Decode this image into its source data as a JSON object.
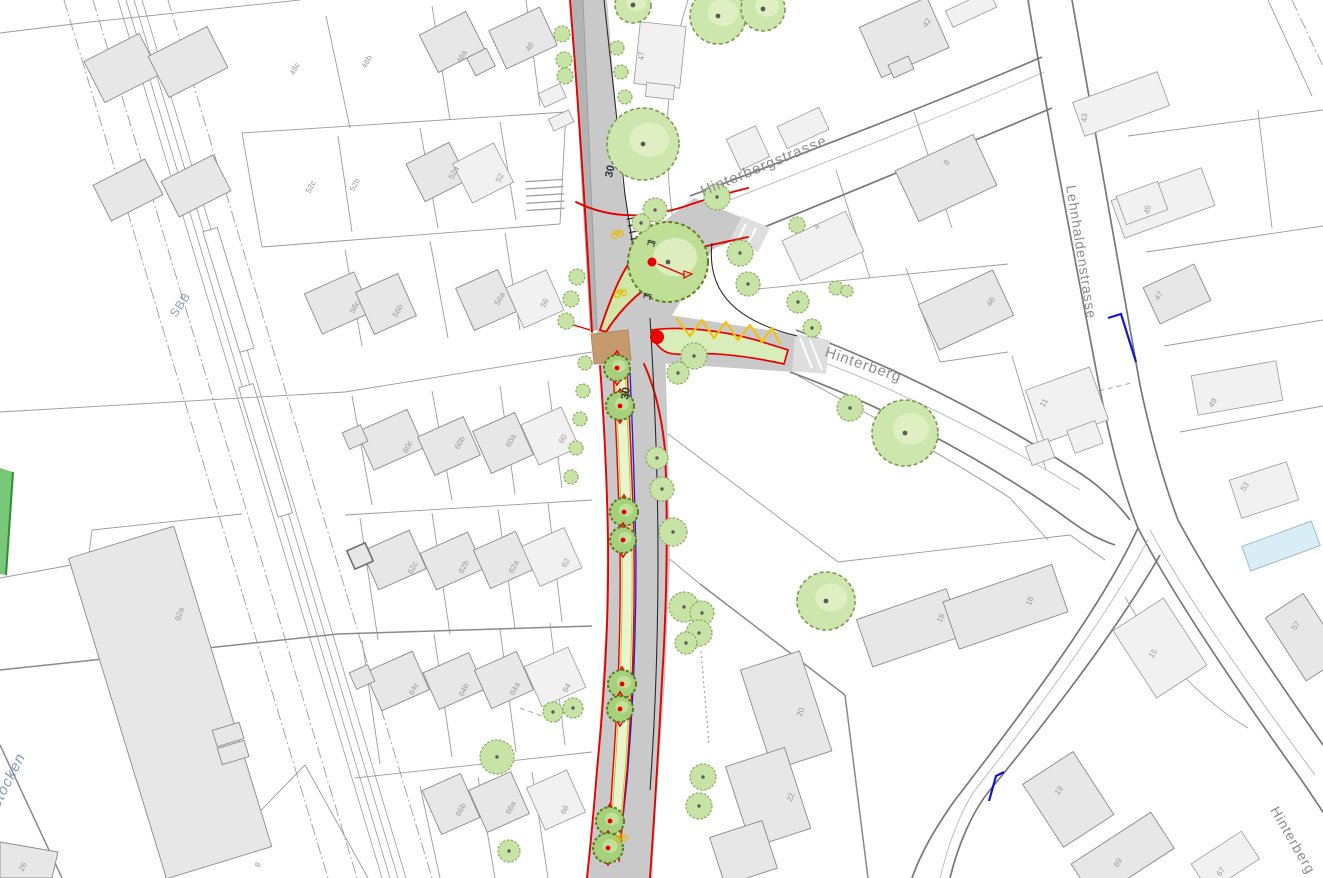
{
  "colors": {
    "parcel_line": "#9c9c9c",
    "road_border": "#787878",
    "building_fill": "#e7e7e7",
    "building_stroke": "#8a8a8a",
    "project_red": "#e60000",
    "road_gray": "#c9c9c9",
    "sidewalk_gray": "#b3b3b3",
    "median_green": "#e9f3ce",
    "tree_fill": "#cde6ad",
    "tree_outline": "#7c9a4e",
    "median_tree_fill": "#a6d07c",
    "median_tree_outline": "#5f7a1b",
    "accent_yellow": "#f2c200",
    "marking_blue": "#1414d2",
    "crossing_brown": "#c49a6e",
    "water_blue": "#d9edf6",
    "grass_green": "#79c879",
    "building_label_gray": "#9a9a9a",
    "street_label_gray": "#8c8c8c",
    "rail_label_blue": "#8d9fb3",
    "marking_label_dark": "#2e3338"
  },
  "streets": {
    "hinterbergstrasse": {
      "text": "Hinterbergstrasse",
      "x": 703,
      "y": 196,
      "rot": -22.5,
      "size": 15,
      "color": "#8c8c8c",
      "style": "normal"
    },
    "hinterberg_mid": {
      "text": "Hinterberg",
      "x": 824,
      "y": 356,
      "rot": 19,
      "size": 15,
      "color": "#8c8c8c",
      "style": "normal"
    },
    "lehnhaldenstrasse": {
      "text": "Lehnhaldenstrasse",
      "x": 1066,
      "y": 186,
      "rot": 81,
      "size": 14,
      "color": "#8c8c8c",
      "style": "normal"
    },
    "hinterberg_br": {
      "text": "Hinterberg",
      "x": 1270,
      "y": 810,
      "rot": 60,
      "size": 14,
      "color": "#8c8c8c",
      "style": "normal"
    },
    "sbb": {
      "text": "SBB",
      "x": 176,
      "y": 318,
      "rot": -56,
      "size": 12,
      "color": "#8d9fb3",
      "style": "normal"
    },
    "erstocken": {
      "text": "erstocken",
      "x": -8,
      "y": 822,
      "rot": -63,
      "size": 15,
      "color": "#7f9cba",
      "style": "italic"
    }
  },
  "road_markings": [
    {
      "text": "30",
      "x": 612,
      "y": 178,
      "rot": -78
    },
    {
      "text": "30",
      "x": 628,
      "y": 400,
      "rot": -80
    }
  ],
  "marking_size": 11,
  "building_labels": [
    {
      "t": "48c",
      "x": 297,
      "y": 70,
      "r": -62
    },
    {
      "t": "48b",
      "x": 369,
      "y": 63,
      "r": -62
    },
    {
      "t": "48a",
      "x": 464,
      "y": 58,
      "r": -62
    },
    {
      "t": "48",
      "x": 532,
      "y": 48,
      "r": -62
    },
    {
      "t": "47",
      "x": 644,
      "y": 56,
      "r": -88
    },
    {
      "t": "42",
      "x": 929,
      "y": 24,
      "r": -58
    },
    {
      "t": "43",
      "x": 1087,
      "y": 118,
      "r": -85
    },
    {
      "t": "45",
      "x": 1150,
      "y": 210,
      "r": -80
    },
    {
      "t": "8",
      "x": 949,
      "y": 164,
      "r": -60
    },
    {
      "t": "4",
      "x": 819,
      "y": 228,
      "r": -60
    },
    {
      "t": "46",
      "x": 993,
      "y": 303,
      "r": -60
    },
    {
      "t": "47",
      "x": 1161,
      "y": 297,
      "r": -60
    },
    {
      "t": "11",
      "x": 1046,
      "y": 404,
      "r": -60
    },
    {
      "t": "49",
      "x": 1215,
      "y": 404,
      "r": -60
    },
    {
      "t": "53",
      "x": 1247,
      "y": 488,
      "r": -58
    },
    {
      "t": "52c",
      "x": 313,
      "y": 188,
      "r": -62
    },
    {
      "t": "52b",
      "x": 357,
      "y": 186,
      "r": -62
    },
    {
      "t": "52a",
      "x": 456,
      "y": 174,
      "r": -62
    },
    {
      "t": "52",
      "x": 502,
      "y": 179,
      "r": -62
    },
    {
      "t": "56c",
      "x": 357,
      "y": 308,
      "r": -62
    },
    {
      "t": "56b",
      "x": 400,
      "y": 312,
      "r": -62
    },
    {
      "t": "56a",
      "x": 502,
      "y": 300,
      "r": -62
    },
    {
      "t": "56",
      "x": 547,
      "y": 304,
      "r": -62
    },
    {
      "t": "60c",
      "x": 410,
      "y": 448,
      "r": -62
    },
    {
      "t": "60b",
      "x": 462,
      "y": 444,
      "r": -62
    },
    {
      "t": "60a",
      "x": 513,
      "y": 442,
      "r": -62
    },
    {
      "t": "60",
      "x": 565,
      "y": 440,
      "r": -62
    },
    {
      "t": "62c",
      "x": 415,
      "y": 569,
      "r": -62
    },
    {
      "t": "62b",
      "x": 466,
      "y": 568,
      "r": -62
    },
    {
      "t": "62a",
      "x": 516,
      "y": 568,
      "r": -62
    },
    {
      "t": "62",
      "x": 568,
      "y": 564,
      "r": -62
    },
    {
      "t": "64c",
      "x": 416,
      "y": 690,
      "r": -62
    },
    {
      "t": "64b",
      "x": 466,
      "y": 691,
      "r": -62
    },
    {
      "t": "64a",
      "x": 517,
      "y": 690,
      "r": -62
    },
    {
      "t": "64",
      "x": 569,
      "y": 689,
      "r": -62
    },
    {
      "t": "66b",
      "x": 463,
      "y": 811,
      "r": -62
    },
    {
      "t": "66a",
      "x": 513,
      "y": 809,
      "r": -62
    },
    {
      "t": "66",
      "x": 567,
      "y": 811,
      "r": -62
    },
    {
      "t": "92a",
      "x": 182,
      "y": 615,
      "r": -73
    },
    {
      "t": "26",
      "x": 25,
      "y": 868,
      "r": -62
    },
    {
      "t": "8",
      "x": 260,
      "y": 866,
      "r": -62
    },
    {
      "t": "20",
      "x": 803,
      "y": 713,
      "r": -70
    },
    {
      "t": "22",
      "x": 793,
      "y": 798,
      "r": -70
    },
    {
      "t": "18",
      "x": 943,
      "y": 619,
      "r": -68
    },
    {
      "t": "16",
      "x": 1032,
      "y": 602,
      "r": -68
    },
    {
      "t": "15",
      "x": 1155,
      "y": 655,
      "r": -55
    },
    {
      "t": "19",
      "x": 1061,
      "y": 792,
      "r": -55
    },
    {
      "t": "69",
      "x": 1120,
      "y": 864,
      "r": -58
    },
    {
      "t": "67",
      "x": 1223,
      "y": 873,
      "r": -58
    },
    {
      "t": "57",
      "x": 1298,
      "y": 627,
      "r": -58
    }
  ],
  "trees": [
    {
      "k": "big",
      "x": 643,
      "y": 144,
      "r": 36
    },
    {
      "k": "big",
      "x": 633,
      "y": 5,
      "r": 18
    },
    {
      "k": "big",
      "x": 718,
      "y": 16,
      "r": 28
    },
    {
      "k": "big",
      "x": 763,
      "y": 9,
      "r": 22
    },
    {
      "k": "big",
      "x": 905,
      "y": 433,
      "r": 33
    },
    {
      "k": "big",
      "x": 826,
      "y": 601,
      "r": 29
    },
    {
      "k": "island",
      "x": 668,
      "y": 262,
      "r": 40
    },
    {
      "k": "s",
      "x": 655,
      "y": 210,
      "r": 12
    },
    {
      "k": "s",
      "x": 641,
      "y": 223,
      "r": 9
    },
    {
      "k": "s",
      "x": 717,
      "y": 197,
      "r": 13
    },
    {
      "k": "s",
      "x": 740,
      "y": 253,
      "r": 13
    },
    {
      "k": "s",
      "x": 748,
      "y": 284,
      "r": 12
    },
    {
      "k": "s",
      "x": 798,
      "y": 302,
      "r": 11
    },
    {
      "k": "s",
      "x": 812,
      "y": 328,
      "r": 9
    },
    {
      "k": "s",
      "x": 797,
      "y": 225,
      "r": 8
    },
    {
      "k": "s",
      "x": 836,
      "y": 288,
      "r": 7
    },
    {
      "k": "s",
      "x": 847,
      "y": 291,
      "r": 6
    },
    {
      "k": "s",
      "x": 694,
      "y": 356,
      "r": 13
    },
    {
      "k": "s",
      "x": 678,
      "y": 373,
      "r": 11
    },
    {
      "k": "s",
      "x": 850,
      "y": 408,
      "r": 13
    },
    {
      "k": "s",
      "x": 657,
      "y": 458,
      "r": 11
    },
    {
      "k": "s",
      "x": 662,
      "y": 489,
      "r": 12
    },
    {
      "k": "s",
      "x": 673,
      "y": 532,
      "r": 14
    },
    {
      "k": "s",
      "x": 684,
      "y": 607,
      "r": 15
    },
    {
      "k": "s",
      "x": 702,
      "y": 613,
      "r": 12
    },
    {
      "k": "s",
      "x": 699,
      "y": 633,
      "r": 13
    },
    {
      "k": "s",
      "x": 686,
      "y": 643,
      "r": 11
    },
    {
      "k": "s",
      "x": 553,
      "y": 712,
      "r": 10
    },
    {
      "k": "s",
      "x": 573,
      "y": 708,
      "r": 10
    },
    {
      "k": "s",
      "x": 497,
      "y": 757,
      "r": 17
    },
    {
      "k": "s",
      "x": 509,
      "y": 851,
      "r": 11
    },
    {
      "k": "s",
      "x": 703,
      "y": 777,
      "r": 13
    },
    {
      "k": "s",
      "x": 699,
      "y": 806,
      "r": 13
    },
    {
      "k": "s",
      "x": 562,
      "y": 34,
      "r": 8
    },
    {
      "k": "s",
      "x": 564,
      "y": 60,
      "r": 8
    },
    {
      "k": "s",
      "x": 565,
      "y": 76,
      "r": 8
    },
    {
      "k": "s",
      "x": 617,
      "y": 48,
      "r": 7
    },
    {
      "k": "s",
      "x": 621,
      "y": 72,
      "r": 7
    },
    {
      "k": "s",
      "x": 625,
      "y": 97,
      "r": 7
    },
    {
      "k": "s",
      "x": 577,
      "y": 277,
      "r": 8
    },
    {
      "k": "s",
      "x": 571,
      "y": 299,
      "r": 8
    },
    {
      "k": "s",
      "x": 566,
      "y": 321,
      "r": 8
    },
    {
      "k": "s",
      "x": 585,
      "y": 363,
      "r": 7
    },
    {
      "k": "s",
      "x": 583,
      "y": 391,
      "r": 7
    },
    {
      "k": "s",
      "x": 580,
      "y": 419,
      "r": 7
    },
    {
      "k": "s",
      "x": 576,
      "y": 448,
      "r": 7
    },
    {
      "k": "s",
      "x": 571,
      "y": 477,
      "r": 7
    },
    {
      "k": "m",
      "x": 617,
      "y": 368,
      "r": 13
    },
    {
      "k": "m",
      "x": 620,
      "y": 406,
      "r": 14
    },
    {
      "k": "m",
      "x": 624,
      "y": 512,
      "r": 14
    },
    {
      "k": "m",
      "x": 623,
      "y": 540,
      "r": 13
    },
    {
      "k": "m",
      "x": 622,
      "y": 684,
      "r": 14
    },
    {
      "k": "m",
      "x": 620,
      "y": 709,
      "r": 13
    },
    {
      "k": "m",
      "x": 610,
      "y": 821,
      "r": 14
    },
    {
      "k": "m",
      "x": 608,
      "y": 848,
      "r": 15
    }
  ],
  "icons": {
    "bikes": [
      {
        "x": 617,
        "y": 233
      },
      {
        "x": 620,
        "y": 292
      },
      {
        "x": 621,
        "y": 837
      }
    ],
    "benches": [
      {
        "x": 651,
        "y": 244,
        "r": 15
      },
      {
        "x": 647,
        "y": 297,
        "r": 15
      }
    ],
    "red_dots": [
      {
        "x": 652,
        "y": 262,
        "r": 4.5
      },
      {
        "x": 657,
        "y": 337,
        "r": 7
      }
    ],
    "flag": {
      "x1": 658,
      "y1": 264,
      "x2": 684,
      "y2": 275
    }
  }
}
